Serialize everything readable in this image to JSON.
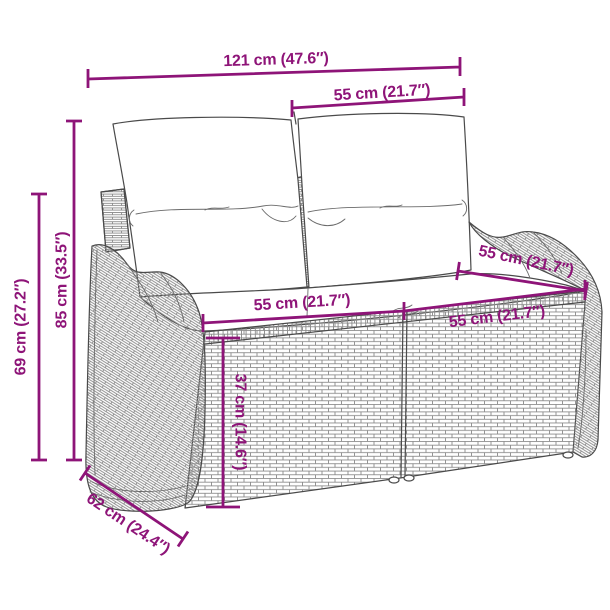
{
  "colors": {
    "accent": "#8E1478",
    "outline": "#4a4a4a",
    "weave": "#8a8a8a"
  },
  "dims": {
    "overall_width": {
      "label": "121 cm (47.6″)"
    },
    "back_cushion_width": {
      "label": "55 cm (21.7″)"
    },
    "height_total": {
      "label": "85 cm (33.5″)"
    },
    "height_back": {
      "label": "69 cm (27.2″)"
    },
    "seat_width_left": {
      "label": "55 cm (21.7″)"
    },
    "seat_width_right": {
      "label": "55 cm (21.7″)"
    },
    "seat_depth": {
      "label": "55 cm (21.7″)"
    },
    "seat_height": {
      "label": "37 cm (14.6″)"
    },
    "depth_total": {
      "label": "62 cm (24.4″)"
    }
  }
}
